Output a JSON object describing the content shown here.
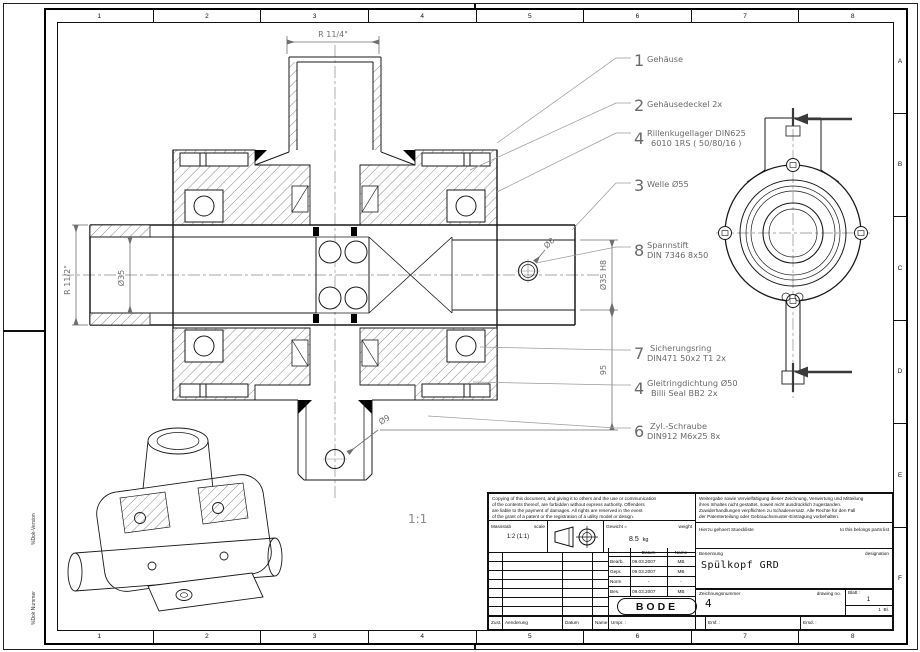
{
  "drawing": {
    "designation": "Spülkopf GRD",
    "company": "BODE",
    "scale_note": "1:1"
  },
  "frame": {
    "top_zones": [
      "1",
      "2",
      "3",
      "4",
      "5",
      "6",
      "7",
      "8"
    ],
    "bottom_zones": [
      "1",
      "2",
      "3",
      "4",
      "5",
      "6",
      "7",
      "8"
    ],
    "right_zones": [
      "A",
      "B",
      "C",
      "D",
      "E",
      "F"
    ],
    "margin_labels": {
      "version": "%Dok-Version",
      "number": "%Dok Nummer"
    }
  },
  "callouts": [
    {
      "num": "1",
      "line1": "Gehäuse",
      "line2": ""
    },
    {
      "num": "2",
      "line1": "Gehäusedeckel 2x",
      "line2": ""
    },
    {
      "num": "4",
      "line1": "Rillenkugellager DIN625",
      "line2": "6010 1RS ( 50/80/16 )"
    },
    {
      "num": "3",
      "line1": "Welle Ø55",
      "line2": ""
    },
    {
      "num": "8",
      "line1": "Spannstift",
      "line2": "DIN 7346 8x50"
    },
    {
      "num": "7",
      "line1": "Sicherungsring",
      "line2": "DIN471 50x2 T1 2x"
    },
    {
      "num": "4",
      "line1": "Gleitringdichtung Ø50",
      "line2": "Billi Seal BB2 2x"
    },
    {
      "num": "6",
      "line1": "Zyl.-Schraube",
      "line2": "DIN912 M6x25 8x"
    }
  ],
  "dims": {
    "top_radius": "R 11/4\"",
    "left_radius": "R 11/2\"",
    "bore_left": "Ø35",
    "pin": "Ø8",
    "bore_right": "Ø35 H8",
    "length": "95",
    "hole": "Ø9"
  },
  "titleblock": {
    "legal_en": [
      "Copying of this document, and giving it to others and the use or communication",
      "of the contents thereof, are forbidden without express authority. Offenders",
      "are liable to the payment of damages. All rights are reserved in the event",
      "of the grant of a patent or the registration of a utility model or design."
    ],
    "legal_de": [
      "Weitergabe sowie Vervielfältigung dieser Zeichnung, Verwertung und Mitteilung",
      "ihres Inhaltes nicht gestattet, soweit nicht ausdrücklich zugestanden.",
      "Zuwiderhandlungen verpflichten zu Schadenersatz. Alle Rechte für den Fall",
      "der Patenterteilung oder Gebrauchsmuster-Eintragung vorbehalten."
    ],
    "scale": {
      "label_de": "Massstab",
      "label_en": "scale",
      "value": "1:2 (1:1)"
    },
    "weight": {
      "label_de": "Gewicht =",
      "label_en": "weight",
      "value": "8.5",
      "unit": "kg"
    },
    "parts_list": {
      "de": "Hierzu gehoert Stueckliste",
      "en": "to this belongs parts list"
    },
    "designation": {
      "label_de": "Benennung",
      "label_en": "designation"
    },
    "drawing_no": {
      "label_de": "Zeichnungsnummer",
      "label_en": "drawing no.",
      "value": "4"
    },
    "sheet": {
      "label": "Blatt :",
      "value": "1",
      "count": "1",
      "suffix": "Bl."
    },
    "approval_header": {
      "date": "Datum",
      "name": "Name"
    },
    "approvals": [
      {
        "label": "Bearb.",
        "date": "09.03.2007",
        "name": "MB"
      },
      {
        "label": "Gepr.",
        "date": "09.03.2007",
        "name": "MB"
      },
      {
        "label": "Norm",
        "date": "-",
        "name": "-"
      },
      {
        "label": "Bes.",
        "date": "09.03.2007",
        "name": "MB"
      }
    ],
    "revision": {
      "zust": "Zust.",
      "aenderung": "Aenderung",
      "datum": "Datum",
      "name": "Name",
      "urspr": "Urspr. :",
      "ersf": "Ersf. :",
      "ersd": "Ersd. :"
    }
  },
  "colors": {
    "line": "#1a1a1a",
    "annotation_gray": "#6f6f6f",
    "background": "#ffffff"
  }
}
